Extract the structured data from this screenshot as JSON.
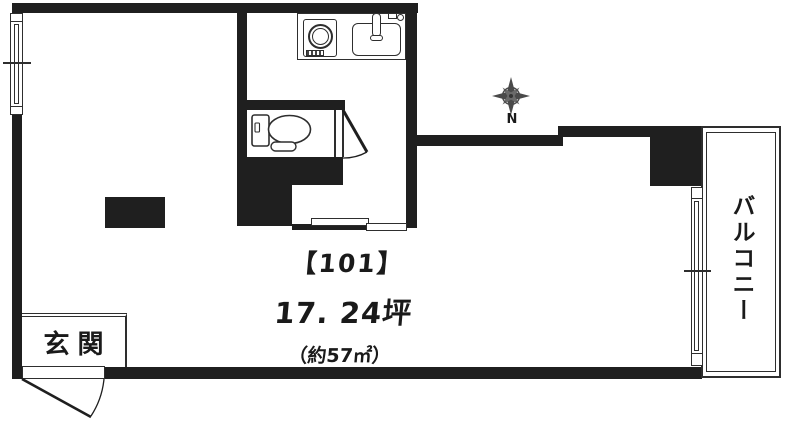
{
  "plan": {
    "unit_label": "【101】",
    "area_tsubo": "17. 24坪",
    "area_sqm": "（約57㎡）",
    "entrance_label": "玄関",
    "balcony_label": "バルコニー",
    "compass_label": "N",
    "colors": {
      "wall": "#1f1f1f",
      "line": "#2e2e2e",
      "background": "#ffffff",
      "text": "#1a1a1a"
    },
    "icons": {
      "compass_rose": "8-point-star",
      "stove": "single-burner-circle",
      "sink": "basin-with-faucet",
      "toilet": "tank-and-bowl",
      "doors": "quarter-arc-swing"
    }
  }
}
